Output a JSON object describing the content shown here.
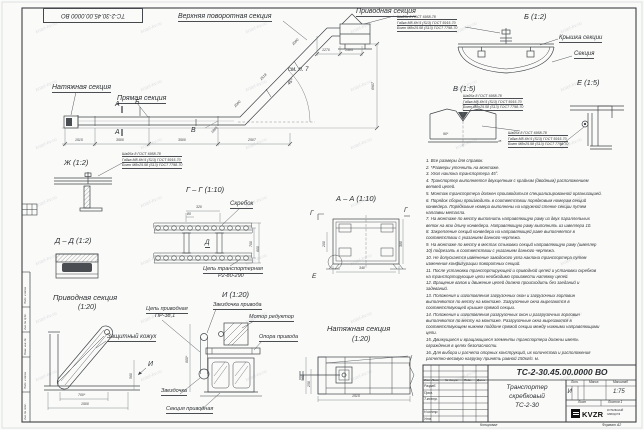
{
  "sheet": {
    "stamp_top": "ТС-2-30.45.00.0000 ВО",
    "watermark": "kotel-kv.ru",
    "copied": "Копировал",
    "format": "Формат А2",
    "frame_labels": [
      "Подп. и дата",
      "Инв. № дубл.",
      "Взам. инв. №",
      "Подп. и дата",
      "Инв. № подл."
    ]
  },
  "main": {
    "upper": "Верхняя поворотная секция",
    "drive": "Приводная секция",
    "tension": "Натяжная секция",
    "straight": "Прямая секция",
    "see_note": "см. п. 7",
    "angle": "45°",
    "mark_a": "А",
    "mark_b": "Б",
    "mark_v": "В",
    "d1515": "1515",
    "d3500": "3500",
    "d2507": "2507",
    "d6907": "6907",
    "d1270": "1270",
    "d1505": "1505",
    "d2000": "2000",
    "d2518": "2518",
    "d1865": "1865"
  },
  "fastener": {
    "l1": "Шайба 8 ГОСТ 6958-78",
    "l2": "Гайка М8-6Н.5 (S13) ГОСТ 5915-70",
    "l3": "Болт М8х25.58 (S13) ГОСТ 7798-70"
  },
  "views": {
    "b": {
      "title": "Б (1:2)",
      "cover": "Крышка секции",
      "section": "Секция"
    },
    "v": {
      "title": "В (1:5)",
      "d90": "90*",
      "d45": "45"
    },
    "e": {
      "title": "Е (1:5)"
    },
    "zh": {
      "title": "Ж (1:2)"
    },
    "gg": {
      "title": "Г – Г (1:10)",
      "scraper": "Скребок",
      "chain1": "Цепь транспортерная",
      "chain2": "Р2-80-290",
      "d320": "320",
      "d80": "80",
      "d700": "700",
      "d600": "600",
      "mark": "Д"
    },
    "aa": {
      "title": "А – А (1:10)",
      "d200": "200",
      "d380": "380",
      "d340": "340",
      "mark_g": "Г",
      "mark_e": "Е"
    },
    "dd": {
      "title": "Д – Д (1:2)"
    },
    "drv": {
      "t1": "Приводная секция",
      "t2": "(1:20)",
      "casing": "Защитный кожух",
      "mark": "И",
      "d700": "700*",
      "d1500": "1500",
      "d560": "560"
    },
    "i": {
      "title": "И (1:20)",
      "sprocket_drive": "Звездочка привода",
      "motor": "Мотор редуктор",
      "support": "Опора привода",
      "chain1": "Цепь приводная",
      "chain2": "ПР-38,1",
      "sprocket": "Звездочка",
      "section": "Секция приводная",
      "d800": "800*"
    },
    "ten": {
      "t1": "Натяжная секция",
      "t2": "(1:20)",
      "d560": "560",
      "d258": "258",
      "d1515": "1515"
    }
  },
  "notes": {
    "items": [
      "1. Все размеры для справок.",
      "2. *Размеры уточнить на монтаже.",
      "3. Угол наклона транспортера 45°.",
      "4. Транспортер выполняется двухцепным с крайним (двойным) расположением ветвей цепей.",
      "5. Монтаж транспортера должен производиться специализированной организацией.",
      "6. Порядок сборки производить в соответствии порядковым номерам секций конвейера. Порядковые номера выполнены на наружной стенке секции путем наплавки металла.",
      "7. На монтаже по месту выполнить направляющую раму из двух параллельных веток на всю длину конвейера. Направляющую раму выполнить из швеллера 10.",
      "8. Закрепление секций конвейера на направляющей раме выполняется в соответствии с указанием данного чертежа.",
      "9. На монтаже по месту в местах стыковки секций направляющую раму (швеллер 10) подрезать в соответствии с указанием данного чертежа.",
      "10. Не допускается изменение заводского угла наклона транспортера путем изменения конфигурации поворотных секций.",
      "11. После установки транспортирующей и приводной цепей и установки скребков на транспортирующие цепи необходимо произвести натяжку цепей.",
      "12. Вращение валов и движение цепей должно происходить без заеданий и задеваний.",
      "13. Положения и изготовления загрузочных окон и загрузочных горловин выполняются по месту на монтаже. Загрузочные окна вырезаются в соответствующей крышке прямой секции.",
      "14. Положения и изготовления разгрузочных окон и разгрузочных горловин выполняются по месту на монтаже. Разгрузочные окна вырезаются в соответствующем нижнем поддоне прямой секции между нижними направляющими цепи.",
      "15. Движущиеся и вращающиеся элементы транспортера должны иметь ограждения в целях безопасности.",
      "16. Для выбора и расчета опорных конструкций, их количества и расположения расчетно-весовую нагрузку принять равной 150кг/п. м."
    ]
  },
  "tb": {
    "designation": "ТС-2-30.45.00.0000 ВО",
    "name1": "Транспортер",
    "name2": "скребковый",
    "name3": "ТС-2-30",
    "h_izm": "Изм.",
    "h_list": "Лист",
    "h_dok": "№ докум.",
    "h_podp": "Подп.",
    "h_data": "Дата",
    "r_razrab": "Разраб.",
    "r_prov": "Пров.",
    "r_tkontr": "Т.контр.",
    "r_nkontr": "Н.контр.",
    "r_utv": "Утв.",
    "h_lit": "Лит.",
    "h_mass": "Масса",
    "h_scale": "Масштаб",
    "lit": "И",
    "scale": "1:75",
    "sheet_lbl": "Лист",
    "sheets_lbl": "Листов 1",
    "logo": "KVZR",
    "logo_s1": "КОТЕЛЬНЫЙ",
    "logo_s2": "ЗАВОД РФ"
  }
}
